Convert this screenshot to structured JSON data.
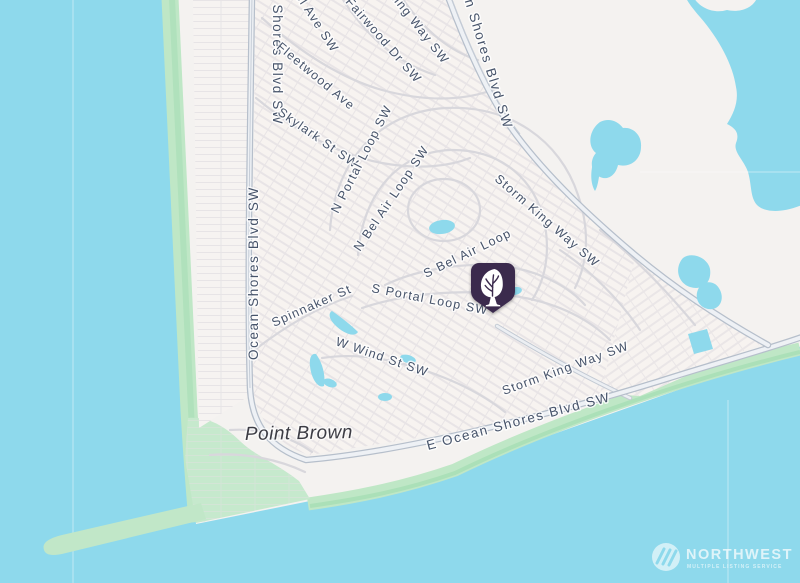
{
  "map": {
    "place": "Point Brown",
    "labels": {
      "west_blvd_partial": "n Shores Blvd SW",
      "west_blvd": "Ocean Shores Blvd SW",
      "ave_partial": "el Ave SW",
      "fairwood": "Fairwood Dr SW",
      "king_way_partial": "King Way SW",
      "ne_blvd_partial": "an Shores Blvd SW",
      "fleetwood": "Fleetwood Ave",
      "skylark": "Skylark St SW",
      "n_portal": "N Portal Loop SW",
      "n_bel_air": "N Bel Air Loop SW",
      "storm_king_upper": "Storm King Way SW",
      "s_bel_air": "S Bel Air Loop",
      "s_portal": "S Portal Loop SW",
      "spinnaker": "Spinnaker St",
      "w_wind": "W Wind St SW",
      "storm_king_lower": "Storm King Way SW",
      "e_ocean_blvd": "E Ocean Shores Blvd SW"
    },
    "marker": {
      "kind": "tree-pin"
    },
    "watermark": {
      "brand": "NORTHWEST",
      "tagline": "MULTIPLE LISTING SERVICE"
    },
    "colors": {
      "water": "#8ed9ec",
      "land": "#f4f2f0",
      "greenbelt": "#bfe7c6",
      "marker_purple": "#3a2a4e",
      "label_text": "#46536a"
    }
  }
}
